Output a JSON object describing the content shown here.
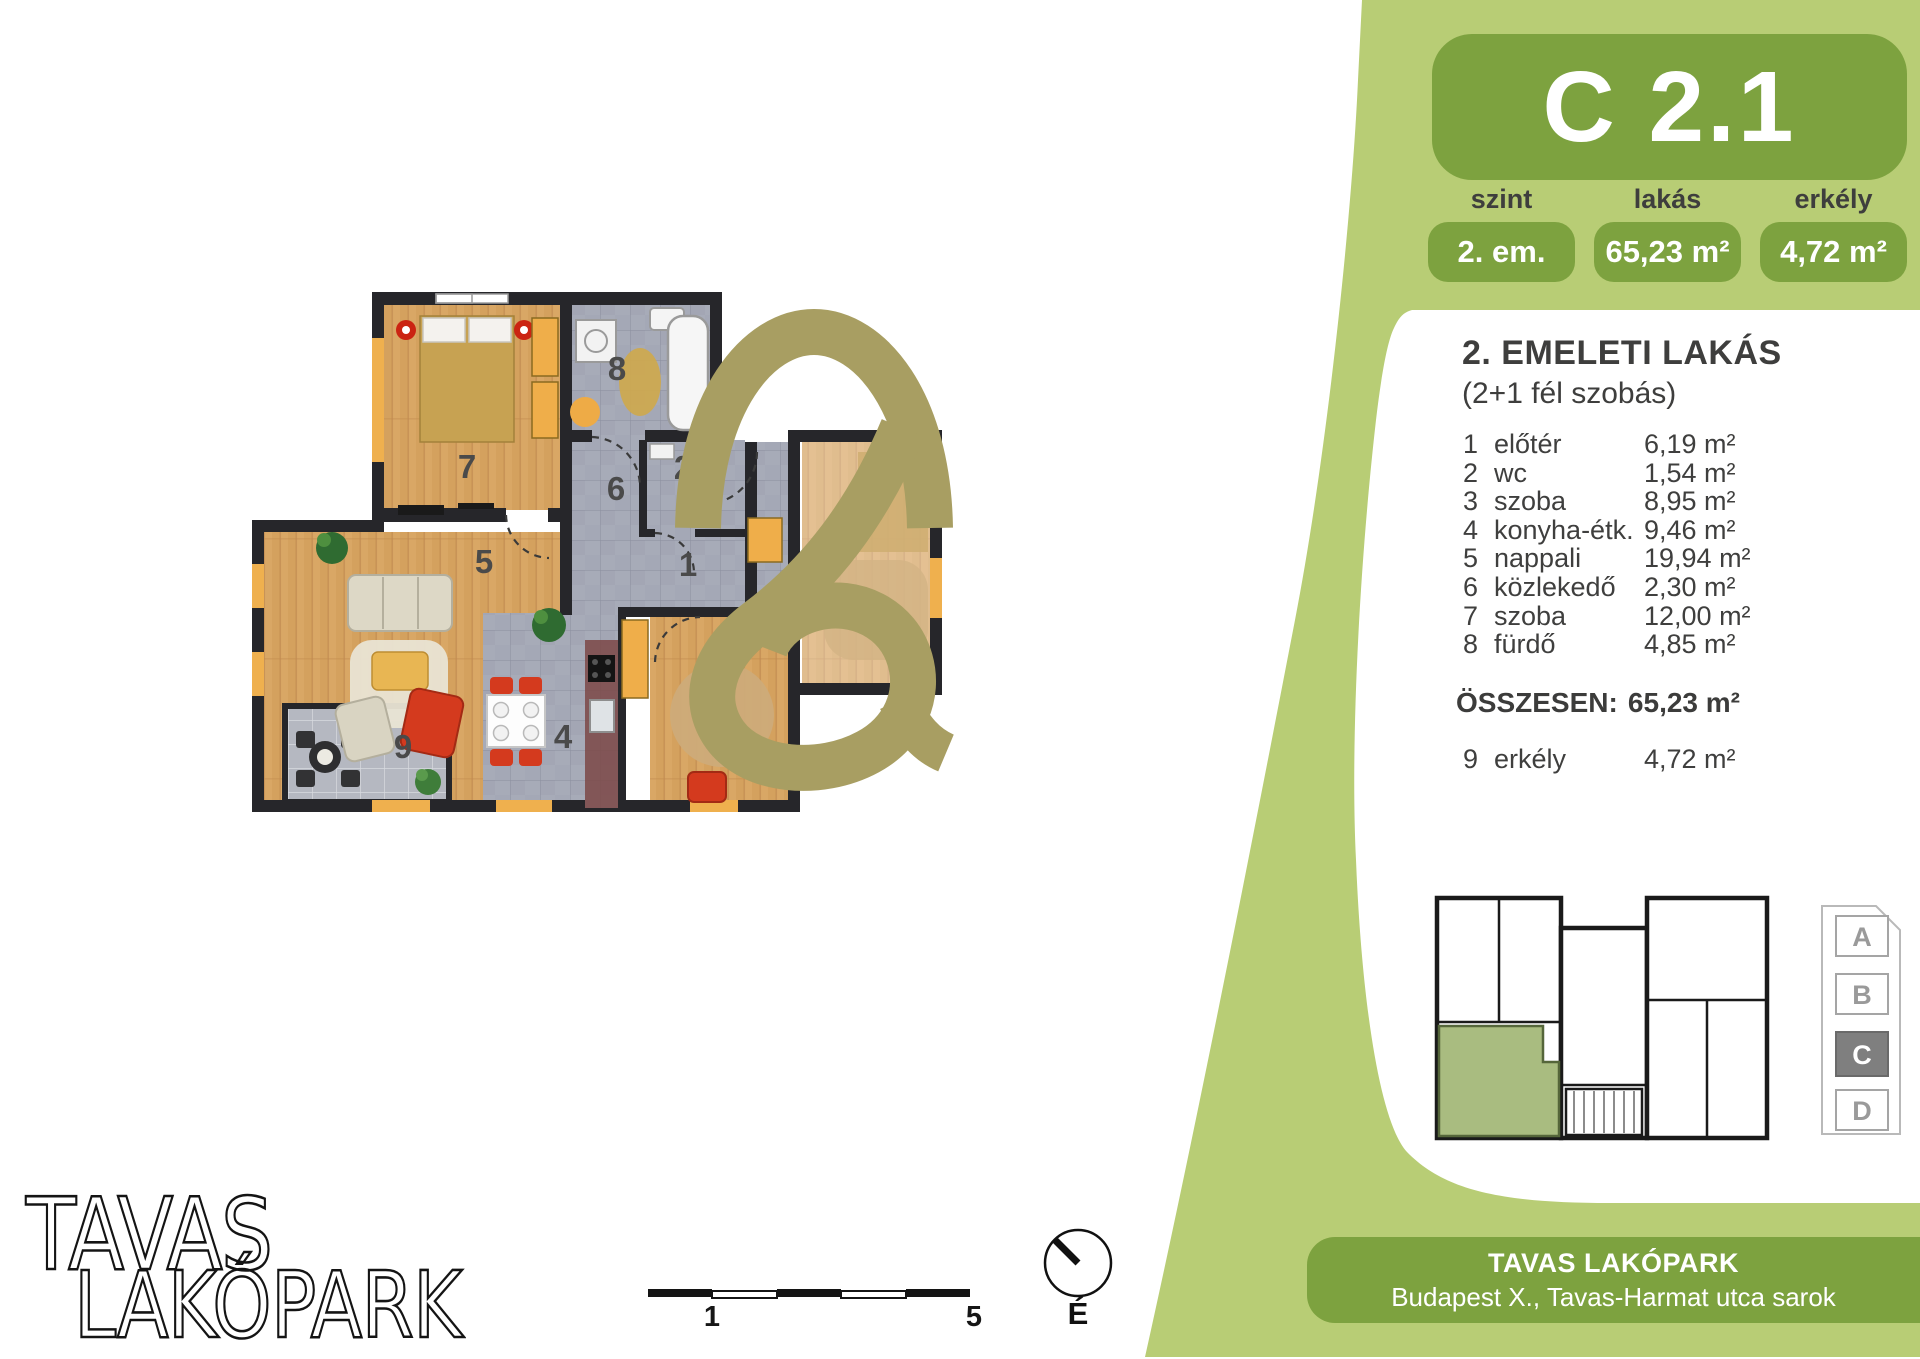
{
  "panel": {
    "unit_code": "C 2.1",
    "stats": [
      {
        "label": "szint",
        "value": "2. em."
      },
      {
        "label": "lakás",
        "value": "65,23 m²"
      },
      {
        "label": "erkély",
        "value": "4,72 m²"
      }
    ],
    "card": {
      "title": "2. EMELETI LAKÁS",
      "subtitle": "(2+1 fél szobás)",
      "rooms": [
        {
          "num": "1",
          "name": "előtér",
          "area": "6,19 m²"
        },
        {
          "num": "2",
          "name": "wc",
          "area": "1,54 m²"
        },
        {
          "num": "3",
          "name": "szoba",
          "area": "8,95 m²"
        },
        {
          "num": "4",
          "name": "konyha-étk.",
          "area": "9,46 m²"
        },
        {
          "num": "5",
          "name": "nappali",
          "area": "19,94 m²"
        },
        {
          "num": "6",
          "name": "közlekedő",
          "area": "2,30 m²"
        },
        {
          "num": "7",
          "name": "szoba",
          "area": "12,00 m²"
        },
        {
          "num": "8",
          "name": "fürdő",
          "area": "4,85 m²"
        }
      ],
      "total_label": "ÖSSZESEN:",
      "total_area": "65,23 m²",
      "balcony": {
        "num": "9",
        "name": "erkély",
        "area": "4,72 m²"
      }
    },
    "building_selector": {
      "options": [
        "A",
        "B",
        "C",
        "D"
      ],
      "active": "C"
    }
  },
  "footer": {
    "project": "TAVAS LAKÓPARK",
    "address": "Budapest X., Tavas-Harmat utca sarok"
  },
  "logo": {
    "line1": "TAVAS",
    "line2": "LAKÓPARK"
  },
  "plan": {
    "room_labels": [
      "7",
      "8",
      "2",
      "6",
      "1",
      "5",
      "4",
      "9"
    ],
    "scale": {
      "start": "1",
      "end": "5"
    },
    "compass": "É"
  },
  "colors": {
    "panel_green": "#b8cd75",
    "accent_green": "#7da23f",
    "logo_olive": "#a89e62"
  }
}
